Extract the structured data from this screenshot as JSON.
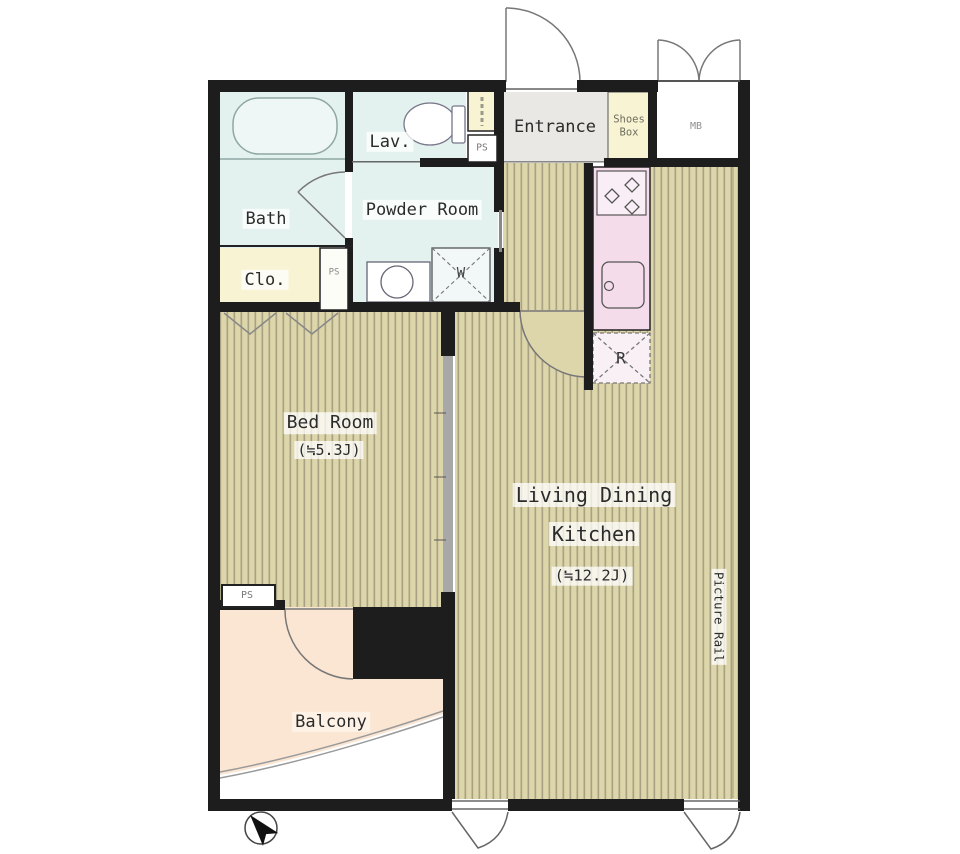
{
  "plan": {
    "type": "apartment-floor-plan",
    "rooms": {
      "bath": "Bath",
      "lav": "Lav.",
      "powder_room": "Powder Room",
      "closet": "Clo.",
      "entrance": "Entrance",
      "shoes_box": "Shoes Box",
      "meter_box": "MB",
      "bed_room": {
        "name": "Bed Room",
        "area": "(≒5.3J)"
      },
      "ldk": {
        "line1": "Living Dining",
        "line2": "Kitchen",
        "area": "(≒12.2J)"
      },
      "balcony": "Balcony"
    },
    "labels": {
      "pipe_space": "PS",
      "washing_machine": "W",
      "refrigerator": "R",
      "picture_rail": "Picture Rail"
    },
    "colors": {
      "wall": "#1d1d1d",
      "flooring": "#ded6ab",
      "flooring_stripe": "#a9a183",
      "wet_area": "#e3f1ef",
      "storage_yellow": "#f8f3d3",
      "kitchen_pink": "#f5dcea",
      "balcony_peach": "#fbe6d3",
      "entrance_gray": "#e9e8e4"
    }
  }
}
